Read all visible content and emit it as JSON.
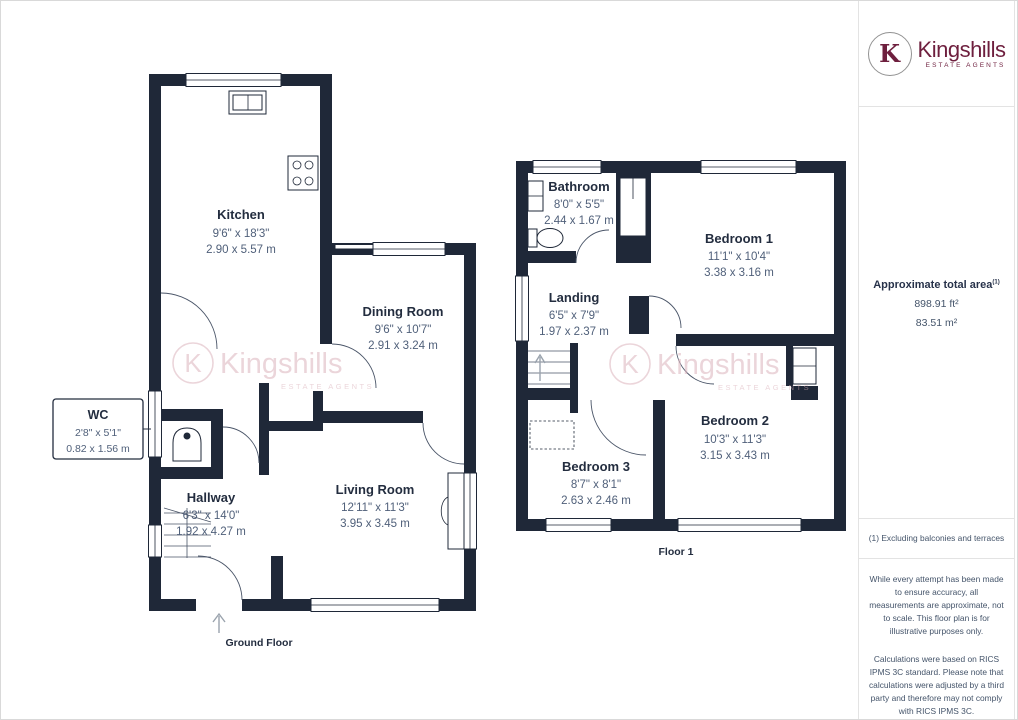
{
  "brand": {
    "logo_letter": "K",
    "name": "Kingshills",
    "tagline": "ESTATE AGENTS",
    "brand_color": "#6e1f3e",
    "watermark": {
      "logo_letter": "K",
      "name": "Kingshills",
      "tagline": "ESTATE AGENTS"
    }
  },
  "colors": {
    "wall": "#1f2838",
    "room_name_text": "#232d3f",
    "dimension_text": "#50607a",
    "watermark_pink": "#dcb3bc"
  },
  "floors": [
    {
      "caption": "Ground Floor",
      "rooms": [
        {
          "name": "Kitchen",
          "dims_imperial": "9'6\" x 18'3\"",
          "dims_metric": "2.90 x 5.57 m"
        },
        {
          "name": "Dining Room",
          "dims_imperial": "9'6\" x 10'7\"",
          "dims_metric": "2.91 x 3.24 m"
        },
        {
          "name": "WC",
          "dims_imperial": "2'8\" x 5'1\"",
          "dims_metric": "0.82 x 1.56 m"
        },
        {
          "name": "Hallway",
          "dims_imperial": "6'3\" x 14'0\"",
          "dims_metric": "1.92 x 4.27 m"
        },
        {
          "name": "Living Room",
          "dims_imperial": "12'11\" x 11'3\"",
          "dims_metric": "3.95 x 3.45 m"
        }
      ]
    },
    {
      "caption": "Floor 1",
      "rooms": [
        {
          "name": "Bathroom",
          "dims_imperial": "8'0\" x 5'5\"",
          "dims_metric": "2.44 x 1.67 m"
        },
        {
          "name": "Bedroom 1",
          "dims_imperial": "11'1\" x 10'4\"",
          "dims_metric": "3.38 x 3.16 m"
        },
        {
          "name": "Landing",
          "dims_imperial": "6'5\" x 7'9\"",
          "dims_metric": "1.97 x 2.37 m"
        },
        {
          "name": "Bedroom 3",
          "dims_imperial": "8'7\" x 8'1\"",
          "dims_metric": "2.63 x 2.46 m"
        },
        {
          "name": "Bedroom 2",
          "dims_imperial": "10'3\" x 11'3\"",
          "dims_metric": "3.15 x 3.43 m"
        }
      ]
    }
  ],
  "sidebar": {
    "area": {
      "title": "Approximate total area",
      "superscript": "(1)",
      "sqft": "898.91 ft²",
      "sqm": "83.51 m²"
    },
    "footnote": "(1) Excluding balconies and terraces",
    "disclaimer1": "While every attempt has been made to ensure accuracy, all measurements are approximate, not to scale. This floor plan is for illustrative purposes only.",
    "disclaimer2": "Calculations were based on RICS IPMS 3C standard. Please note that calculations were adjusted by a third party and therefore may not comply with RICS IPMS 3C.",
    "credit_brand": "GIRAFFE",
    "credit_bold": "360"
  }
}
